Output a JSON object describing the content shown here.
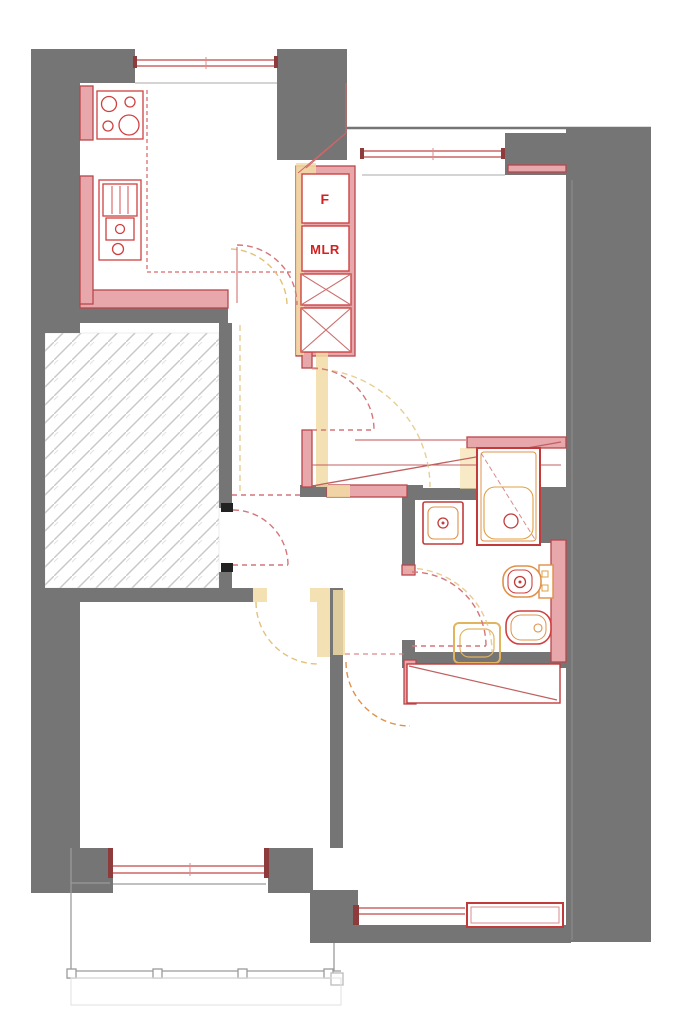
{
  "plan": {
    "title": "apartment-renovation-floor-plan",
    "labels": {
      "fridge": "F",
      "mlr": "MLR"
    },
    "colors": {
      "wall_existing": "#757575",
      "wall_new_fill": "#e8a7ab",
      "wall_new_edge": "#b8474c",
      "demolition_yellow": "#f3dca6",
      "demolition_line": "#e2b45e",
      "fixture_red": "#c23b3b",
      "fixture_orange": "#e09048",
      "door_arc_red": "#d4767a",
      "window_line": "#d98c8c",
      "hatch_line": "#c8c8c8",
      "balcony_line": "#9a9a9a",
      "label_red": "#d42020"
    },
    "fixtures": [
      "stove",
      "kitchen-sink",
      "fridge-cabinet",
      "mlr-cabinet",
      "shower",
      "hand-basin",
      "toilet",
      "bidet",
      "old-basin",
      "wardrobe",
      "radiator"
    ]
  }
}
